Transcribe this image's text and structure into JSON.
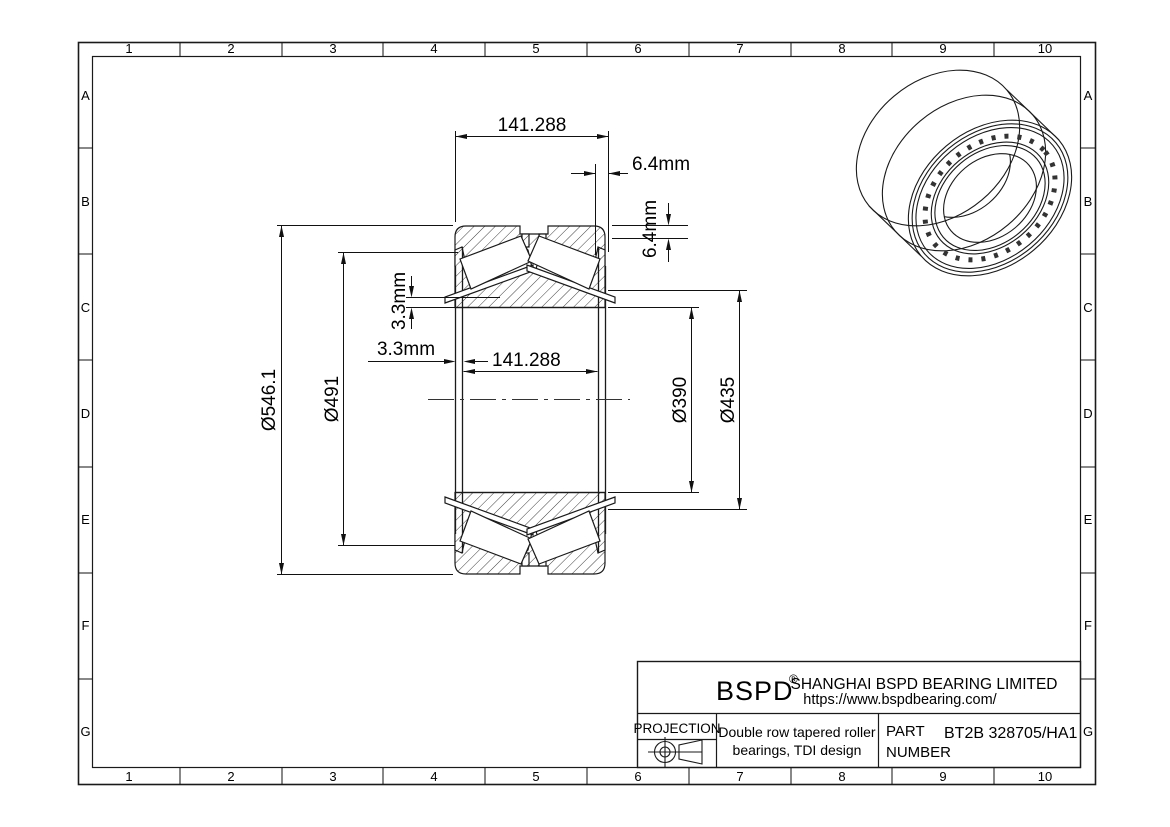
{
  "page": {
    "background": "#ffffff",
    "line_color": "#1a1a1a"
  },
  "grid": {
    "columns": [
      "1",
      "2",
      "3",
      "4",
      "5",
      "6",
      "7",
      "8",
      "9",
      "10"
    ],
    "rows": [
      "A",
      "B",
      "C",
      "D",
      "E",
      "F",
      "G"
    ]
  },
  "section_view": {
    "dimensions": {
      "outer_width": "141.288",
      "right_offset": "6.4mm",
      "right_offset_vertical": "6.4mm",
      "left_offset_vertical": "3.3mm",
      "left_offset": "3.3mm",
      "inner_width": "141.288",
      "outer_diameter": "Ø546.1",
      "cup_bore_diameter": "Ø491",
      "rib_diameter": "Ø435",
      "bore_diameter": "Ø390"
    }
  },
  "title_block": {
    "logo": "BSPD",
    "registered_mark": "®",
    "company": "SHANGHAI BSPD BEARING LIMITED",
    "website": "https://www.bspdbearing.com/",
    "projection_label": "PROJECTION",
    "projection_icon": "first-angle-projection-icon",
    "description_line1": "Double row tapered roller",
    "description_line2": "bearings, TDI design",
    "part_label_line1": "PART",
    "part_label_line2": "NUMBER",
    "part_number": "BT2B 328705/HA1"
  }
}
